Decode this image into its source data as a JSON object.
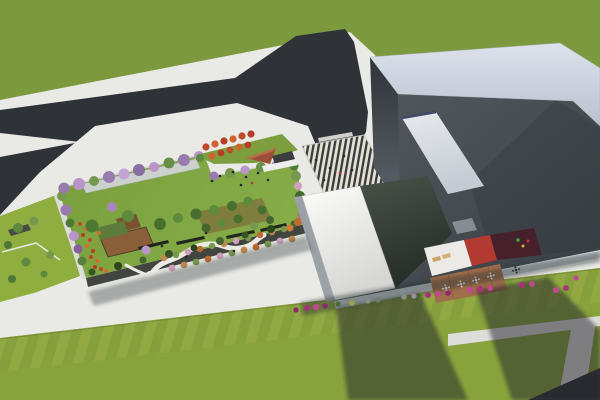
{
  "palette": {
    "grassTop": "#7c993e",
    "grassBottom": "#88a23c",
    "grassBright": "#8fae3f",
    "pavement": "#e9e9e6",
    "pavementShade": "#dcdcd8",
    "road": "#2f3236",
    "cross": "#e0e0da",
    "canopy": "#ccd1ce",
    "canopyWhite": "#eceded",
    "facade": "#41443f",
    "fascia": "#e6e6e2",
    "fasciaB": "#c3c8cd",
    "soil": "#7a5a36",
    "pergola": "#4a4a46",
    "deckA": "#8a5f38",
    "deckArm": "#7a5230",
    "roofGreen": "#5d7c3b",
    "bench": "#23261f",
    "mound": "#7c9e3e",
    "triRed": "#9c4f38",
    "triTop": "#c06a4a",
    "shelter": "#3a3d40",
    "wingSide": "#9ba1a6",
    "terWhite": "#eceae6",
    "terRed": "#b23a31",
    "terMaroon": "#46202a",
    "terDeck": "#a06e4b",
    "lounger": "#c9a266",
    "lounger2": "#d4b078",
    "smallSky": "#8d949b",
    "buildingLightTop": "#dde2ec",
    "buildingLightBottom": "#b9c1ce",
    "roofDarkLight": "#545a60",
    "roofDarkDeep": "#383e43",
    "skylightEdge": "#3e4a66",
    "glassTop": "#4a524a",
    "glassBottom": "#272e28",
    "shadow": "rgba(33,38,42,0.5)",
    "shadowSoft": "rgba(45,50,55,0.35)",
    "shadowStreet": "rgba(40,44,48,0.42)"
  },
  "scatter_groups": [
    {
      "name": "left-strip-trees",
      "item": "tree",
      "color": "#5d8a3c",
      "points": [
        {
          "x": 18,
          "y": 228,
          "r": 5
        },
        {
          "x": 34,
          "y": 221,
          "r": 4.5,
          "c": "#76994e"
        },
        {
          "x": 8,
          "y": 245,
          "r": 4,
          "c": "#4d7733"
        },
        {
          "x": 26,
          "y": 262,
          "r": 4.5
        },
        {
          "x": 50,
          "y": 255,
          "r": 4,
          "c": "#76994e"
        },
        {
          "x": 12,
          "y": 279,
          "r": 4,
          "c": "#4d7733"
        },
        {
          "x": 44,
          "y": 274,
          "r": 3.5
        }
      ]
    },
    {
      "name": "garden-top-trees",
      "item": "blossom-tree",
      "color": "#9a7bb0",
      "points": [
        {
          "x": 64,
          "y": 188,
          "r": 5.5
        },
        {
          "x": 79,
          "y": 184,
          "r": 6,
          "c": "#b995c9"
        },
        {
          "x": 94,
          "y": 181,
          "r": 5,
          "c": "#74984c"
        },
        {
          "x": 109,
          "y": 177,
          "r": 6
        },
        {
          "x": 124,
          "y": 174,
          "r": 5.5,
          "c": "#c4a2d4"
        },
        {
          "x": 139,
          "y": 170,
          "r": 6,
          "c": "#8a6da3"
        },
        {
          "x": 154,
          "y": 167,
          "r": 5,
          "c": "#b995c9"
        },
        {
          "x": 169,
          "y": 163,
          "r": 5.5,
          "c": "#678f45"
        },
        {
          "x": 184,
          "y": 160,
          "r": 6
        },
        {
          "x": 199,
          "y": 156,
          "r": 5,
          "c": "#b995c9"
        },
        {
          "x": 214,
          "y": 176,
          "r": 4.5
        },
        {
          "x": 230,
          "y": 173,
          "r": 5,
          "c": "#74984c"
        },
        {
          "x": 245,
          "y": 170,
          "r": 4.5,
          "c": "#b995c9"
        },
        {
          "x": 261,
          "y": 167,
          "r": 5,
          "c": "#678f45"
        },
        {
          "x": 276,
          "y": 165,
          "r": 4.5,
          "c": "#a886bd"
        },
        {
          "x": 291,
          "y": 162,
          "r": 4.5,
          "c": "#74984c"
        }
      ]
    },
    {
      "name": "garden-left-trees",
      "item": "tree",
      "color": "#76994e",
      "points": [
        {
          "x": 62,
          "y": 196,
          "r": 5
        },
        {
          "x": 66,
          "y": 210,
          "r": 5.5,
          "c": "#9a7bb0"
        },
        {
          "x": 70,
          "y": 223,
          "r": 4.5,
          "c": "#4f7a35"
        },
        {
          "x": 74,
          "y": 236,
          "r": 5,
          "c": "#b995c9"
        },
        {
          "x": 78,
          "y": 249,
          "r": 4.5,
          "c": "#8a5f9e"
        },
        {
          "x": 82,
          "y": 261,
          "r": 4.5,
          "c": "#567f3a"
        }
      ]
    },
    {
      "name": "garden-right-trees",
      "item": "tree",
      "color": "#4f7a35",
      "points": [
        {
          "x": 294,
          "y": 166,
          "r": 4.5
        },
        {
          "x": 296,
          "y": 176,
          "r": 5,
          "c": "#76994e"
        },
        {
          "x": 298,
          "y": 186,
          "r": 4,
          "c": "#cf9fbe"
        },
        {
          "x": 300,
          "y": 196,
          "r": 5,
          "c": "#3f6a2c"
        },
        {
          "x": 301,
          "y": 206,
          "r": 4.5,
          "c": "#76994e"
        },
        {
          "x": 302,
          "y": 215,
          "r": 4,
          "c": "#b06a9e"
        },
        {
          "x": 298,
          "y": 222,
          "r": 4,
          "c": "#c06a30"
        },
        {
          "x": 290,
          "y": 228,
          "r": 3.5,
          "c": "#d07a35"
        }
      ]
    },
    {
      "name": "garden-hedge",
      "item": "hedge-tree",
      "color": "#375426",
      "points": [
        {
          "x": 92,
          "y": 272,
          "r": 3.5
        },
        {
          "x": 118,
          "y": 266,
          "r": 4,
          "c": "#2c451f"
        },
        {
          "x": 143,
          "y": 260,
          "r": 3.5,
          "c": "#44662e"
        },
        {
          "x": 169,
          "y": 254,
          "r": 4
        },
        {
          "x": 194,
          "y": 248,
          "r": 3.5,
          "c": "#2c451f"
        },
        {
          "x": 220,
          "y": 241,
          "r": 4,
          "c": "#44662e"
        },
        {
          "x": 245,
          "y": 235,
          "r": 3.5
        },
        {
          "x": 271,
          "y": 229,
          "r": 4,
          "c": "#2c451f"
        },
        {
          "x": 294,
          "y": 224,
          "r": 3.5,
          "c": "#44662e"
        }
      ]
    },
    {
      "name": "garden-interior-trees",
      "item": "tree",
      "color": "#476f2f",
      "points": [
        {
          "x": 92,
          "y": 226,
          "r": 6.5,
          "c": "#4d7733"
        },
        {
          "x": 112,
          "y": 207,
          "r": 5,
          "c": "#a886bd"
        },
        {
          "x": 128,
          "y": 216,
          "r": 6,
          "c": "#5d8a3c"
        },
        {
          "x": 146,
          "y": 250,
          "r": 4.5,
          "c": "#b995c9"
        },
        {
          "x": 160,
          "y": 224,
          "r": 6
        },
        {
          "x": 178,
          "y": 218,
          "r": 5,
          "c": "#5d8a3c"
        },
        {
          "x": 196,
          "y": 214,
          "r": 5.5
        },
        {
          "x": 214,
          "y": 210,
          "r": 5,
          "c": "#5d8a3c"
        },
        {
          "x": 232,
          "y": 206,
          "r": 5
        },
        {
          "x": 248,
          "y": 201,
          "r": 4.5,
          "c": "#5d8a3c"
        },
        {
          "x": 262,
          "y": 210,
          "r": 4.5
        },
        {
          "x": 206,
          "y": 228,
          "r": 4.5,
          "c": "#44662e"
        },
        {
          "x": 222,
          "y": 223,
          "r": 4,
          "c": "#5d8a3c"
        },
        {
          "x": 238,
          "y": 219,
          "r": 4.5
        },
        {
          "x": 254,
          "y": 226,
          "r": 4,
          "c": "#76994e"
        },
        {
          "x": 270,
          "y": 220,
          "r": 4,
          "c": "#44662e"
        }
      ]
    },
    {
      "name": "garden-shrubs",
      "item": "shrub",
      "color": "#c08a4e",
      "points": [
        {
          "x": 164,
          "y": 258,
          "r": 3.2
        },
        {
          "x": 176,
          "y": 255,
          "r": 3.2,
          "c": "#76994e"
        },
        {
          "x": 188,
          "y": 252,
          "r": 3.2,
          "c": "#cf9fbe"
        },
        {
          "x": 200,
          "y": 249,
          "r": 3.2,
          "c": "#bd6a33"
        },
        {
          "x": 212,
          "y": 246,
          "r": 3.2,
          "c": "#76994e"
        },
        {
          "x": 224,
          "y": 244,
          "r": 3.2
        },
        {
          "x": 236,
          "y": 241,
          "r": 3.2,
          "c": "#cf9fbe"
        },
        {
          "x": 248,
          "y": 238,
          "r": 3.2,
          "c": "#76994e"
        },
        {
          "x": 260,
          "y": 235,
          "r": 3.2,
          "c": "#bd6a33"
        },
        {
          "x": 272,
          "y": 232,
          "r": 3.2
        },
        {
          "x": 284,
          "y": 229,
          "r": 3.2,
          "c": "#76994e"
        },
        {
          "x": 172,
          "y": 268,
          "r": 3.4,
          "c": "#cf9fbe"
        },
        {
          "x": 184,
          "y": 265,
          "r": 3.4
        },
        {
          "x": 196,
          "y": 262,
          "r": 3.4,
          "c": "#76994e"
        },
        {
          "x": 208,
          "y": 259,
          "r": 3.4,
          "c": "#bd6a33"
        },
        {
          "x": 220,
          "y": 256,
          "r": 3.4,
          "c": "#cf9fbe"
        },
        {
          "x": 232,
          "y": 253,
          "r": 3.4,
          "c": "#76994e"
        },
        {
          "x": 244,
          "y": 250,
          "r": 3.4
        },
        {
          "x": 256,
          "y": 247,
          "r": 3.4,
          "c": "#bd6a33"
        },
        {
          "x": 268,
          "y": 244,
          "r": 3.4,
          "c": "#76994e"
        },
        {
          "x": 280,
          "y": 241,
          "r": 3.4,
          "c": "#cf9fbe"
        },
        {
          "x": 292,
          "y": 239,
          "r": 3.4
        }
      ]
    },
    {
      "name": "garden-red-flowers",
      "item": "flower-patch",
      "color": "#c44327",
      "points": [
        {
          "x": 80,
          "y": 224,
          "r": 2
        },
        {
          "x": 86,
          "y": 229,
          "r": 2,
          "c": "#d96b2e"
        },
        {
          "x": 83,
          "y": 235,
          "r": 2,
          "c": "#b53a20"
        },
        {
          "x": 90,
          "y": 240,
          "r": 2
        },
        {
          "x": 87,
          "y": 246,
          "r": 2,
          "c": "#d96b2e"
        },
        {
          "x": 93,
          "y": 251,
          "r": 2,
          "c": "#b53a20"
        },
        {
          "x": 91,
          "y": 257,
          "r": 2
        },
        {
          "x": 97,
          "y": 261,
          "r": 2,
          "c": "#d96b2e"
        },
        {
          "x": 95,
          "y": 267,
          "r": 2,
          "c": "#b53a20"
        },
        {
          "x": 101,
          "y": 269,
          "r": 2
        },
        {
          "x": 106,
          "y": 271,
          "r": 2,
          "c": "#d96b2e"
        },
        {
          "x": 99,
          "y": 233,
          "r": 2,
          "c": "#d96b2e"
        }
      ]
    },
    {
      "name": "mound-red-trees",
      "item": "red-tree",
      "color": "#c0492a",
      "points": [
        {
          "x": 206,
          "y": 147,
          "r": 3.6
        },
        {
          "x": 215,
          "y": 144,
          "r": 3.6,
          "c": "#d3612f"
        },
        {
          "x": 224,
          "y": 141,
          "r": 3.6,
          "c": "#b53d24"
        },
        {
          "x": 233,
          "y": 139,
          "r": 3.6,
          "c": "#d3612f"
        },
        {
          "x": 242,
          "y": 136,
          "r": 3.6
        },
        {
          "x": 251,
          "y": 134,
          "r": 3.6,
          "c": "#b53d24"
        },
        {
          "x": 212,
          "y": 156,
          "r": 3.4,
          "c": "#d3612f"
        },
        {
          "x": 221,
          "y": 153,
          "r": 3.4,
          "c": "#b53d24"
        },
        {
          "x": 230,
          "y": 150,
          "r": 3.4
        },
        {
          "x": 239,
          "y": 147,
          "r": 3.4,
          "c": "#d3612f"
        },
        {
          "x": 248,
          "y": 145,
          "r": 3.4,
          "c": "#b53d24"
        },
        {
          "x": 200,
          "y": 158,
          "r": 4,
          "c": "#5d8a3c"
        }
      ]
    },
    {
      "name": "plaza-planters",
      "item": "planter",
      "color": "#c2498f",
      "points": [
        {
          "x": 330,
          "y": 196,
          "r": 2.6
        },
        {
          "x": 339,
          "y": 194,
          "r": 2.6
        },
        {
          "x": 348,
          "y": 193,
          "r": 2.6,
          "c": "#5b7c3a"
        },
        {
          "x": 357,
          "y": 191,
          "r": 2.6
        },
        {
          "x": 366,
          "y": 189,
          "r": 2.6,
          "c": "#a8307c"
        },
        {
          "x": 374,
          "y": 187,
          "r": 2.6
        }
      ]
    },
    {
      "name": "street-shrubs",
      "item": "shrub",
      "color": "#c2498f",
      "points": [
        {
          "x": 307,
          "y": 308,
          "r": 3,
          "c": "#a8307c"
        },
        {
          "x": 316,
          "y": 307,
          "r": 3.2
        },
        {
          "x": 325,
          "y": 306,
          "r": 2.8,
          "c": "#8f2a68"
        },
        {
          "x": 338,
          "y": 304,
          "r": 2.6,
          "c": "#4f6b35"
        },
        {
          "x": 352,
          "y": 303,
          "r": 3,
          "c": "#9aa04a"
        },
        {
          "x": 368,
          "y": 301,
          "r": 2.6,
          "c": "#8a8d85"
        },
        {
          "x": 378,
          "y": 300,
          "r": 2.6,
          "c": "#75786e"
        },
        {
          "x": 404,
          "y": 297,
          "r": 2.8,
          "c": "#8a8d85"
        },
        {
          "x": 414,
          "y": 296,
          "r": 2.6,
          "c": "#9b8f98"
        },
        {
          "x": 428,
          "y": 295,
          "r": 3,
          "c": "#a8307c"
        },
        {
          "x": 438,
          "y": 294,
          "r": 3
        },
        {
          "x": 448,
          "y": 293,
          "r": 2.8,
          "c": "#8f2a68"
        },
        {
          "x": 470,
          "y": 290,
          "r": 3
        },
        {
          "x": 480,
          "y": 289,
          "r": 3,
          "c": "#a8307c"
        },
        {
          "x": 490,
          "y": 288,
          "r": 2.8
        },
        {
          "x": 522,
          "y": 285,
          "r": 3,
          "c": "#a8307c"
        },
        {
          "x": 532,
          "y": 284,
          "r": 2.8
        },
        {
          "x": 556,
          "y": 290,
          "r": 3
        },
        {
          "x": 566,
          "y": 288,
          "r": 2.8,
          "c": "#a8307c"
        },
        {
          "x": 576,
          "y": 278,
          "r": 2.6
        },
        {
          "x": 296,
          "y": 310,
          "r": 2.6,
          "c": "#8f2a68"
        }
      ]
    },
    {
      "name": "people",
      "item": "person",
      "color": "#26282a",
      "points": [
        {
          "x": 162,
          "y": 246,
          "r": 1.3
        },
        {
          "x": 186,
          "y": 257,
          "r": 1.3
        },
        {
          "x": 206,
          "y": 233,
          "r": 1.3
        },
        {
          "x": 234,
          "y": 251,
          "r": 1.3
        },
        {
          "x": 220,
          "y": 176,
          "r": 1.3
        },
        {
          "x": 233,
          "y": 172,
          "r": 1.3
        },
        {
          "x": 246,
          "y": 177,
          "r": 1.3
        },
        {
          "x": 258,
          "y": 173,
          "r": 1.3
        },
        {
          "x": 268,
          "y": 180,
          "r": 1.3
        },
        {
          "x": 241,
          "y": 185,
          "r": 1.3
        },
        {
          "x": 212,
          "y": 181,
          "r": 1.3
        },
        {
          "x": 252,
          "y": 183,
          "r": 1.3,
          "c": "#a83a32"
        },
        {
          "x": 316,
          "y": 160,
          "r": 1.3
        },
        {
          "x": 330,
          "y": 168,
          "r": 1.3
        },
        {
          "x": 344,
          "y": 156,
          "r": 1.3
        },
        {
          "x": 324,
          "y": 180,
          "r": 1.3
        },
        {
          "x": 352,
          "y": 170,
          "r": 1.3
        },
        {
          "x": 340,
          "y": 173,
          "r": 1.3,
          "c": "#a83a32"
        }
      ]
    },
    {
      "name": "terrace-tables",
      "item": "table-part",
      "color": "#f2f2f0",
      "points": [
        {
          "x": 446,
          "y": 288,
          "r": 1.3
        },
        {
          "x": 443,
          "y": 288.7,
          "r": 1
        },
        {
          "x": 449,
          "y": 287.3,
          "r": 1
        },
        {
          "x": 445.3,
          "y": 285.4,
          "r": 1
        },
        {
          "x": 446.7,
          "y": 290.6,
          "r": 1
        },
        {
          "x": 461,
          "y": 284,
          "r": 1.3
        },
        {
          "x": 458,
          "y": 284.7,
          "r": 1
        },
        {
          "x": 464,
          "y": 283.3,
          "r": 1
        },
        {
          "x": 460.3,
          "y": 281.4,
          "r": 1
        },
        {
          "x": 461.7,
          "y": 286.6,
          "r": 1
        },
        {
          "x": 476,
          "y": 280,
          "r": 1.3
        },
        {
          "x": 473,
          "y": 280.7,
          "r": 1
        },
        {
          "x": 479,
          "y": 279.3,
          "r": 1
        },
        {
          "x": 475.3,
          "y": 277.4,
          "r": 1
        },
        {
          "x": 476.7,
          "y": 282.6,
          "r": 1
        },
        {
          "x": 491,
          "y": 276,
          "r": 1.3
        },
        {
          "x": 488,
          "y": 276.7,
          "r": 1
        },
        {
          "x": 494,
          "y": 275.3,
          "r": 1
        },
        {
          "x": 490.3,
          "y": 273.4,
          "r": 1
        },
        {
          "x": 491.7,
          "y": 278.6,
          "r": 1
        },
        {
          "x": 516,
          "y": 270,
          "r": 1.3,
          "c": "#2f332f"
        },
        {
          "x": 513,
          "y": 270.7,
          "r": 1,
          "c": "#2f332f"
        },
        {
          "x": 519,
          "y": 269.3,
          "r": 1,
          "c": "#2f332f"
        },
        {
          "x": 515.3,
          "y": 267.4,
          "r": 1,
          "c": "#2f332f"
        },
        {
          "x": 516.7,
          "y": 272.6,
          "r": 1,
          "c": "#2f332f"
        }
      ]
    },
    {
      "name": "terrace-figures",
      "item": "person",
      "color": "#3fae3e",
      "points": [
        {
          "x": 518,
          "y": 240,
          "r": 1.7
        },
        {
          "x": 523,
          "y": 246,
          "r": 1.5,
          "c": "#d9b23a"
        },
        {
          "x": 528,
          "y": 241,
          "r": 1.5,
          "c": "#c23a30"
        }
      ]
    }
  ]
}
